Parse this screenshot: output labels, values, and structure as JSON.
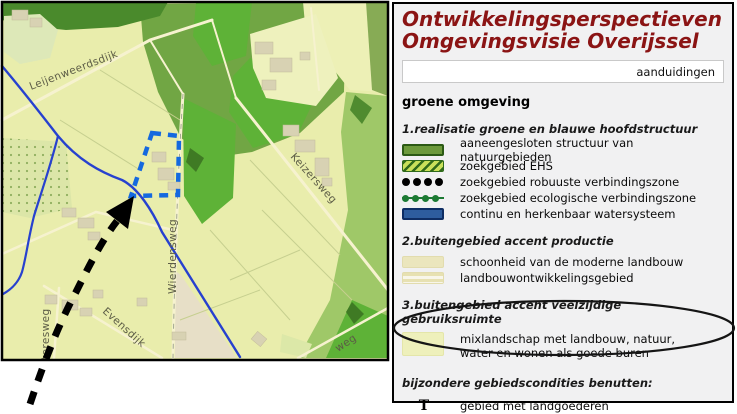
{
  "header": {
    "title_line1": "Ontwikkelingsperspectieven",
    "title_line2": "Omgevingsvisie Overijssel"
  },
  "toolbar": {
    "aanduidingen_label": "aanduidingen"
  },
  "legend": {
    "heading": "groene omgeving",
    "section1": {
      "title": "1.realisatie groene en blauwe hoofdstructuur",
      "items": [
        {
          "swatch": "solid-green",
          "label": "aaneengesloten structuur van natuurgebieden"
        },
        {
          "swatch": "green-hatch",
          "label": "zoekgebied EHS"
        },
        {
          "swatch": "black-dots",
          "label": "zoekgebied robuuste verbindingszone"
        },
        {
          "swatch": "green-dots",
          "label": "zoekgebied ecologische verbindingszone"
        },
        {
          "swatch": "solid-blue",
          "label": "continu en herkenbaar watersysteem"
        }
      ]
    },
    "section2": {
      "title": "2.buitengebied accent productie",
      "items": [
        {
          "swatch": "solid-cream",
          "label": "schoonheid van de moderne landbouw"
        },
        {
          "swatch": "cream-stripes",
          "label": "landbouwontwikkelingsgebied"
        }
      ]
    },
    "section3": {
      "title": "3.buitengebied accent veelzijdige gebruiksruimte",
      "items": [
        {
          "swatch": "pale-yellow",
          "label": "mixlandschap met landbouw, natuur, water en wonen als goede buren",
          "circled": true
        }
      ]
    },
    "section4": {
      "title": "bijzondere gebiedscondities benutten:",
      "items": [
        {
          "symbol": "T",
          "label": "gebied met landgoederen"
        }
      ]
    }
  },
  "map": {
    "road_labels": [
      {
        "text": "Leijenweerdsdijk"
      },
      {
        "text": "Keizersweg"
      },
      {
        "text": "Wierdensweg"
      },
      {
        "text": "Evensdijk"
      },
      {
        "text": "teresweg"
      },
      {
        "text": "weg"
      }
    ]
  },
  "colors": {
    "title_red": "#8b1414",
    "river_blue": "#2741cf",
    "selection_blue": "#1569df",
    "dark_green": "#4a8a2c",
    "mid_green": "#71a644",
    "bright_green": "#5eb237",
    "soft_green": "#9fc868",
    "pale_base": "#e9edac",
    "cream_swatch": "#ebe6bd",
    "water_swatch": "#2e5d9e",
    "annotation_black": "#111111"
  }
}
